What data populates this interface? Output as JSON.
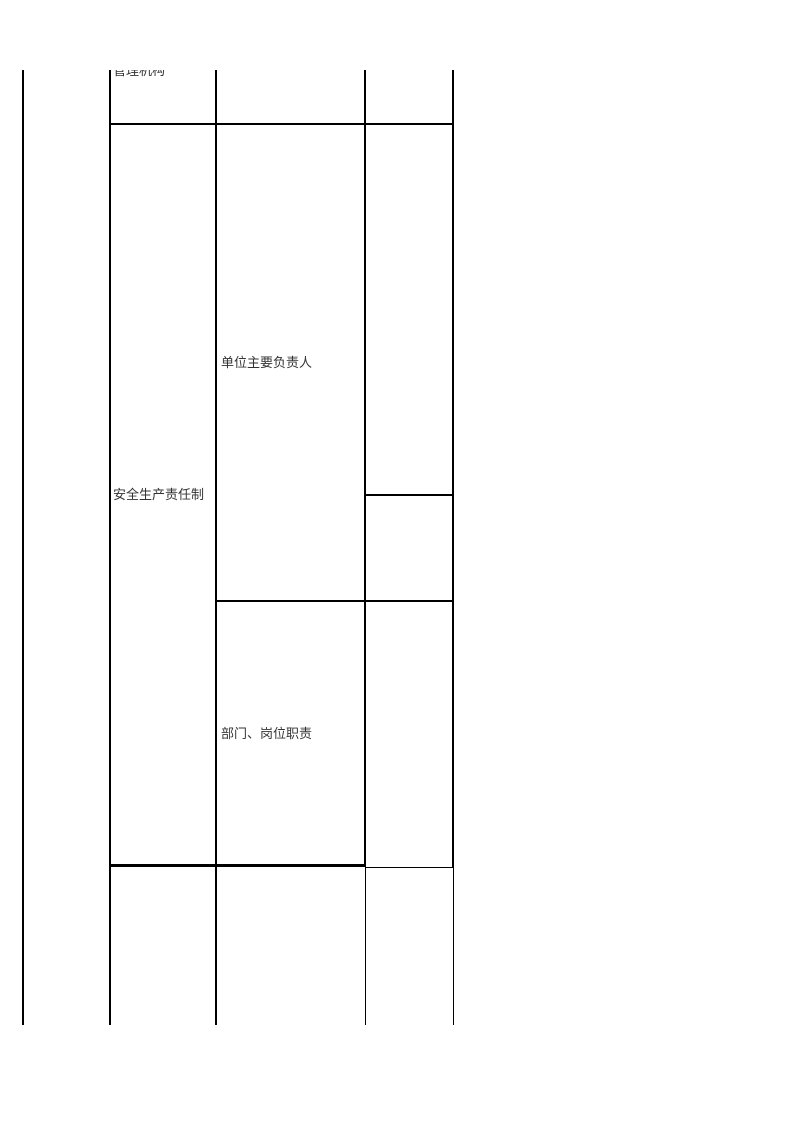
{
  "document": {
    "kind": "table-page",
    "colors": {
      "page_background": "#ffffff",
      "table_border": "#000000",
      "text": "#333333"
    },
    "table": {
      "cells": {
        "management_organization": "管理机构",
        "safety_production_responsibility": "安全生产责任制",
        "unit_main_person_in_charge": "单位主要负责人",
        "department_position_duties": "部门、岗位职责"
      }
    }
  }
}
